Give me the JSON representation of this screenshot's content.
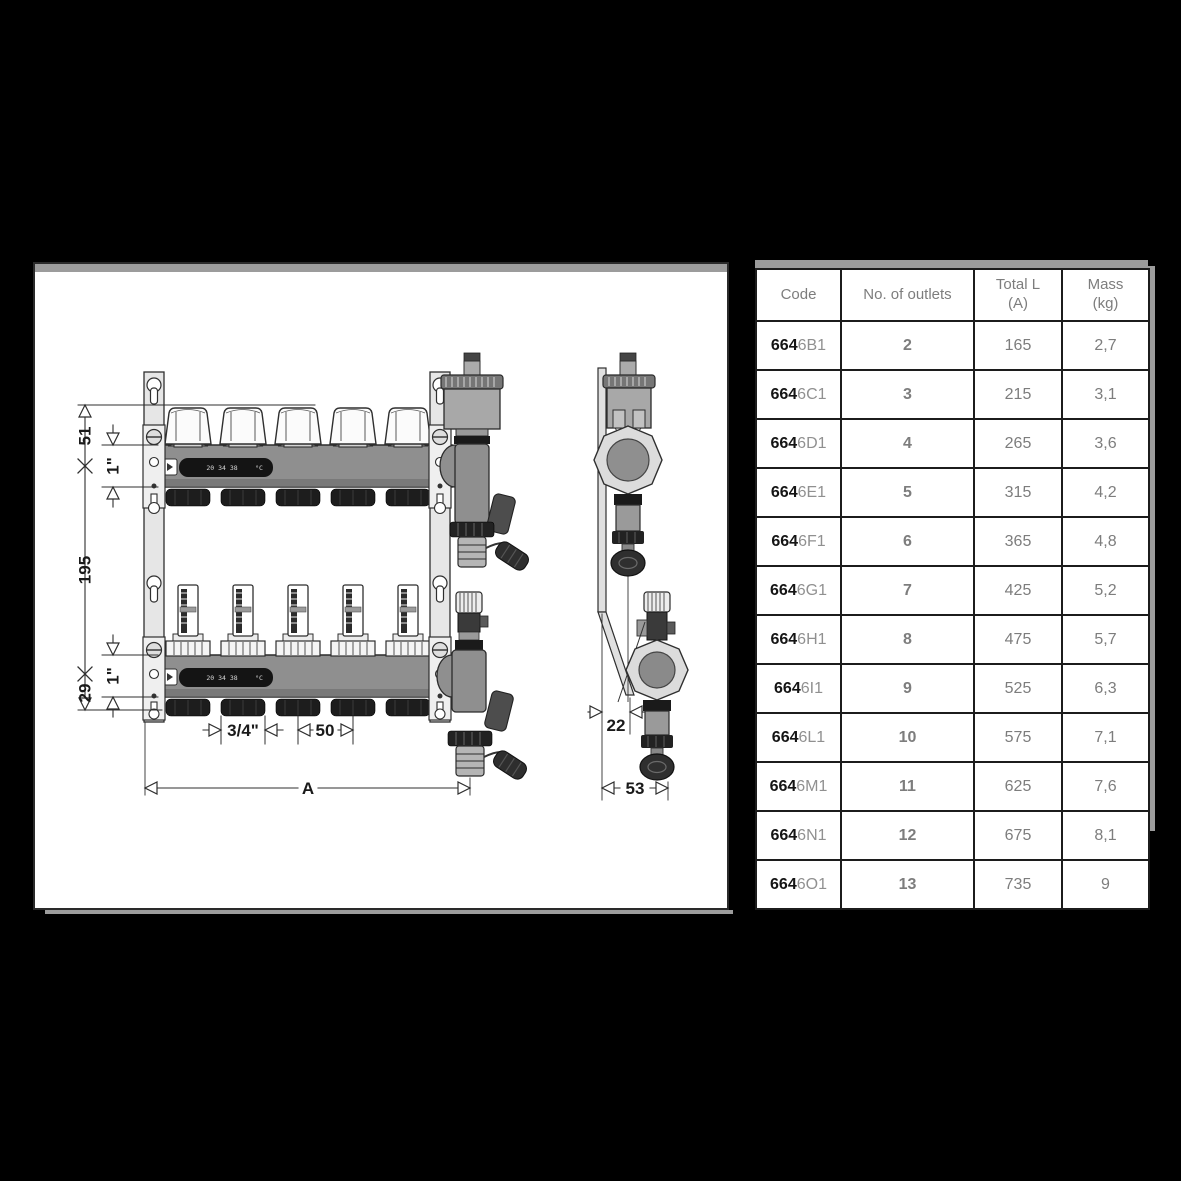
{
  "page": {
    "background": "#000000",
    "paper": "#ffffff",
    "shadow": "#9c9c9c"
  },
  "drawing_panel": {
    "dimensions": {
      "cap_height": "51",
      "top_pipe_size": "1\"",
      "center_spacing": "195",
      "bottom_pipe_size": "1\"",
      "bottom_offset": "29",
      "outlet_thread": "3/4\"",
      "outlet_spacing": "50",
      "overall_length": "A",
      "side_offset": "22",
      "side_depth": "53"
    },
    "thermometer_strip": {
      "scale": "20 34 38",
      "unit": "°C"
    }
  },
  "spec_table": {
    "headers": [
      {
        "line1": "Code",
        "line2": ""
      },
      {
        "line1": "No. of outlets",
        "line2": ""
      },
      {
        "line1": "Total L",
        "line2": "(A)"
      },
      {
        "line1": "Mass",
        "line2": "(kg)"
      }
    ],
    "rows": [
      {
        "code_prefix": "664",
        "code_suffix": "6B1",
        "outlets": "2",
        "total_l": "165",
        "mass": "2,7"
      },
      {
        "code_prefix": "664",
        "code_suffix": "6C1",
        "outlets": "3",
        "total_l": "215",
        "mass": "3,1"
      },
      {
        "code_prefix": "664",
        "code_suffix": "6D1",
        "outlets": "4",
        "total_l": "265",
        "mass": "3,6"
      },
      {
        "code_prefix": "664",
        "code_suffix": "6E1",
        "outlets": "5",
        "total_l": "315",
        "mass": "4,2"
      },
      {
        "code_prefix": "664",
        "code_suffix": "6F1",
        "outlets": "6",
        "total_l": "365",
        "mass": "4,8"
      },
      {
        "code_prefix": "664",
        "code_suffix": "6G1",
        "outlets": "7",
        "total_l": "425",
        "mass": "5,2"
      },
      {
        "code_prefix": "664",
        "code_suffix": "6H1",
        "outlets": "8",
        "total_l": "475",
        "mass": "5,7"
      },
      {
        "code_prefix": "664",
        "code_suffix": "6I1",
        "outlets": "9",
        "total_l": "525",
        "mass": "6,3"
      },
      {
        "code_prefix": "664",
        "code_suffix": "6L1",
        "outlets": "10",
        "total_l": "575",
        "mass": "7,1"
      },
      {
        "code_prefix": "664",
        "code_suffix": "6M1",
        "outlets": "11",
        "total_l": "625",
        "mass": "7,6"
      },
      {
        "code_prefix": "664",
        "code_suffix": "6N1",
        "outlets": "12",
        "total_l": "675",
        "mass": "8,1"
      },
      {
        "code_prefix": "664",
        "code_suffix": "6O1",
        "outlets": "13",
        "total_l": "735",
        "mass": "9"
      }
    ]
  }
}
